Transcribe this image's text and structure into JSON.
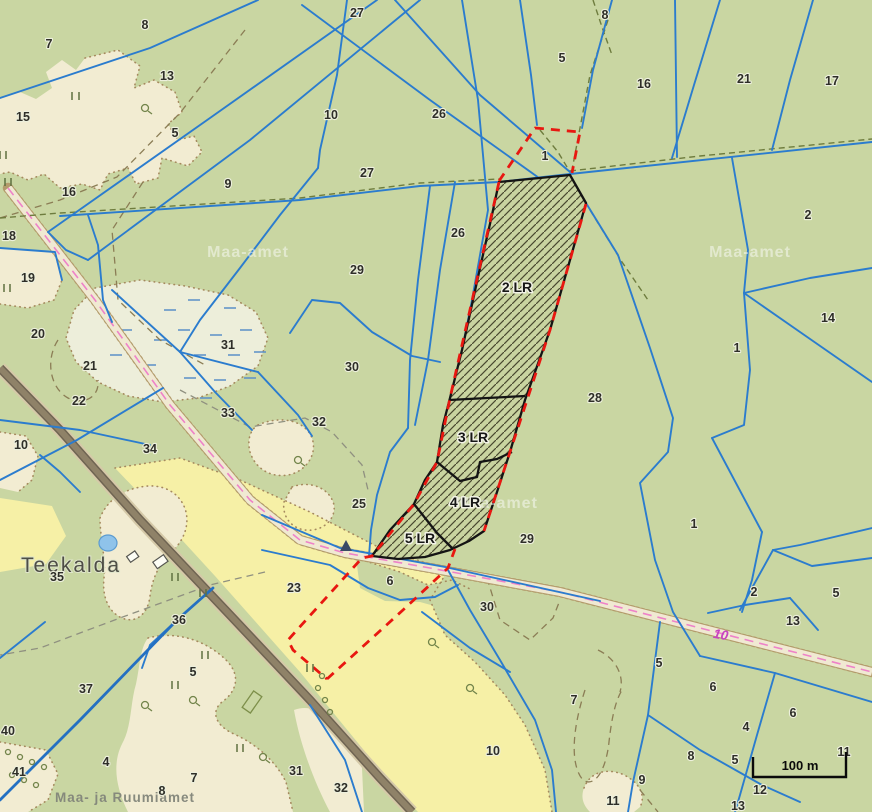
{
  "map": {
    "place_name": "Teekalda",
    "place_name_sub": "35",
    "road_number": "10",
    "scale_bar_label": "100 m",
    "watermarks": [
      {
        "text": "Maa-amet",
        "x": 248,
        "y": 257
      },
      {
        "text": "Maa-amet",
        "x": 750,
        "y": 257
      },
      {
        "text": "Maa-amet",
        "x": 497,
        "y": 508
      },
      {
        "text": "Maa- ja Ruumiamet",
        "x": 125,
        "y": 802
      }
    ],
    "target_parcels": [
      {
        "label": "2 LR",
        "x": 517,
        "y": 292
      },
      {
        "label": "3 LR",
        "x": 473,
        "y": 442
      },
      {
        "label": "4 LR",
        "x": 465,
        "y": 507
      },
      {
        "label": "5 LR",
        "x": 420,
        "y": 543
      }
    ],
    "parcel_numbers": [
      {
        "t": "7",
        "x": 49,
        "y": 48
      },
      {
        "t": "8",
        "x": 145,
        "y": 29
      },
      {
        "t": "27",
        "x": 357,
        "y": 17
      },
      {
        "t": "8",
        "x": 605,
        "y": 19
      },
      {
        "t": "5",
        "x": 562,
        "y": 62
      },
      {
        "t": "16",
        "x": 644,
        "y": 88
      },
      {
        "t": "21",
        "x": 744,
        "y": 83
      },
      {
        "t": "17",
        "x": 832,
        "y": 85
      },
      {
        "t": "13",
        "x": 167,
        "y": 80
      },
      {
        "t": "15",
        "x": 23,
        "y": 121
      },
      {
        "t": "5",
        "x": 175,
        "y": 137
      },
      {
        "t": "10",
        "x": 331,
        "y": 119
      },
      {
        "t": "26",
        "x": 439,
        "y": 118
      },
      {
        "t": "27",
        "x": 367,
        "y": 177
      },
      {
        "t": "1",
        "x": 545,
        "y": 160
      },
      {
        "t": "9",
        "x": 228,
        "y": 188
      },
      {
        "t": "16",
        "x": 69,
        "y": 196
      },
      {
        "t": "18",
        "x": 9,
        "y": 240
      },
      {
        "t": "19",
        "x": 28,
        "y": 282
      },
      {
        "t": "2",
        "x": 808,
        "y": 219
      },
      {
        "t": "26",
        "x": 458,
        "y": 237
      },
      {
        "t": "29",
        "x": 357,
        "y": 274
      },
      {
        "t": "20",
        "x": 38,
        "y": 338
      },
      {
        "t": "31",
        "x": 228,
        "y": 349
      },
      {
        "t": "14",
        "x": 828,
        "y": 322
      },
      {
        "t": "1",
        "x": 737,
        "y": 352
      },
      {
        "t": "30",
        "x": 352,
        "y": 371
      },
      {
        "t": "21",
        "x": 90,
        "y": 370
      },
      {
        "t": "22",
        "x": 79,
        "y": 405
      },
      {
        "t": "33",
        "x": 228,
        "y": 417
      },
      {
        "t": "32",
        "x": 319,
        "y": 426
      },
      {
        "t": "28",
        "x": 595,
        "y": 402
      },
      {
        "t": "10",
        "x": 21,
        "y": 449
      },
      {
        "t": "34",
        "x": 150,
        "y": 453
      },
      {
        "t": "25",
        "x": 359,
        "y": 508
      },
      {
        "t": "1",
        "x": 694,
        "y": 528
      },
      {
        "t": "29",
        "x": 527,
        "y": 543
      },
      {
        "t": "23",
        "x": 294,
        "y": 592
      },
      {
        "t": "36",
        "x": 179,
        "y": 624
      },
      {
        "t": "6",
        "x": 390,
        "y": 585
      },
      {
        "t": "30",
        "x": 487,
        "y": 611
      },
      {
        "t": "2",
        "x": 754,
        "y": 596
      },
      {
        "t": "5",
        "x": 836,
        "y": 597
      },
      {
        "t": "13",
        "x": 793,
        "y": 625
      },
      {
        "t": "37",
        "x": 86,
        "y": 693
      },
      {
        "t": "5",
        "x": 193,
        "y": 676
      },
      {
        "t": "40",
        "x": 8,
        "y": 735
      },
      {
        "t": "41",
        "x": 19,
        "y": 776
      },
      {
        "t": "4",
        "x": 106,
        "y": 766
      },
      {
        "t": "7",
        "x": 194,
        "y": 782
      },
      {
        "t": "8",
        "x": 162,
        "y": 795
      },
      {
        "t": "31",
        "x": 296,
        "y": 775
      },
      {
        "t": "32",
        "x": 341,
        "y": 792
      },
      {
        "t": "7",
        "x": 574,
        "y": 704
      },
      {
        "t": "10",
        "x": 493,
        "y": 755
      },
      {
        "t": "5",
        "x": 659,
        "y": 667
      },
      {
        "t": "6",
        "x": 713,
        "y": 691
      },
      {
        "t": "6",
        "x": 793,
        "y": 717
      },
      {
        "t": "4",
        "x": 746,
        "y": 731
      },
      {
        "t": "8",
        "x": 691,
        "y": 760
      },
      {
        "t": "5",
        "x": 735,
        "y": 764
      },
      {
        "t": "11",
        "x": 844,
        "y": 756
      },
      {
        "t": "9",
        "x": 642,
        "y": 784
      },
      {
        "t": "11",
        "x": 613,
        "y": 805
      },
      {
        "t": "12",
        "x": 760,
        "y": 794
      },
      {
        "t": "13",
        "x": 738,
        "y": 810
      }
    ],
    "colors": {
      "background": "#c9d6a2",
      "field_yellow": "#f6f0a6",
      "open_beige": "#f2ecd2",
      "wetland_pale": "#edeeda",
      "parcel_line_blue": "#2b7cce",
      "boundary_red": "#e81710",
      "target_outline_black": "#141414",
      "road_pink_center": "#ee82c8",
      "road_brown": "#8d8066"
    }
  }
}
